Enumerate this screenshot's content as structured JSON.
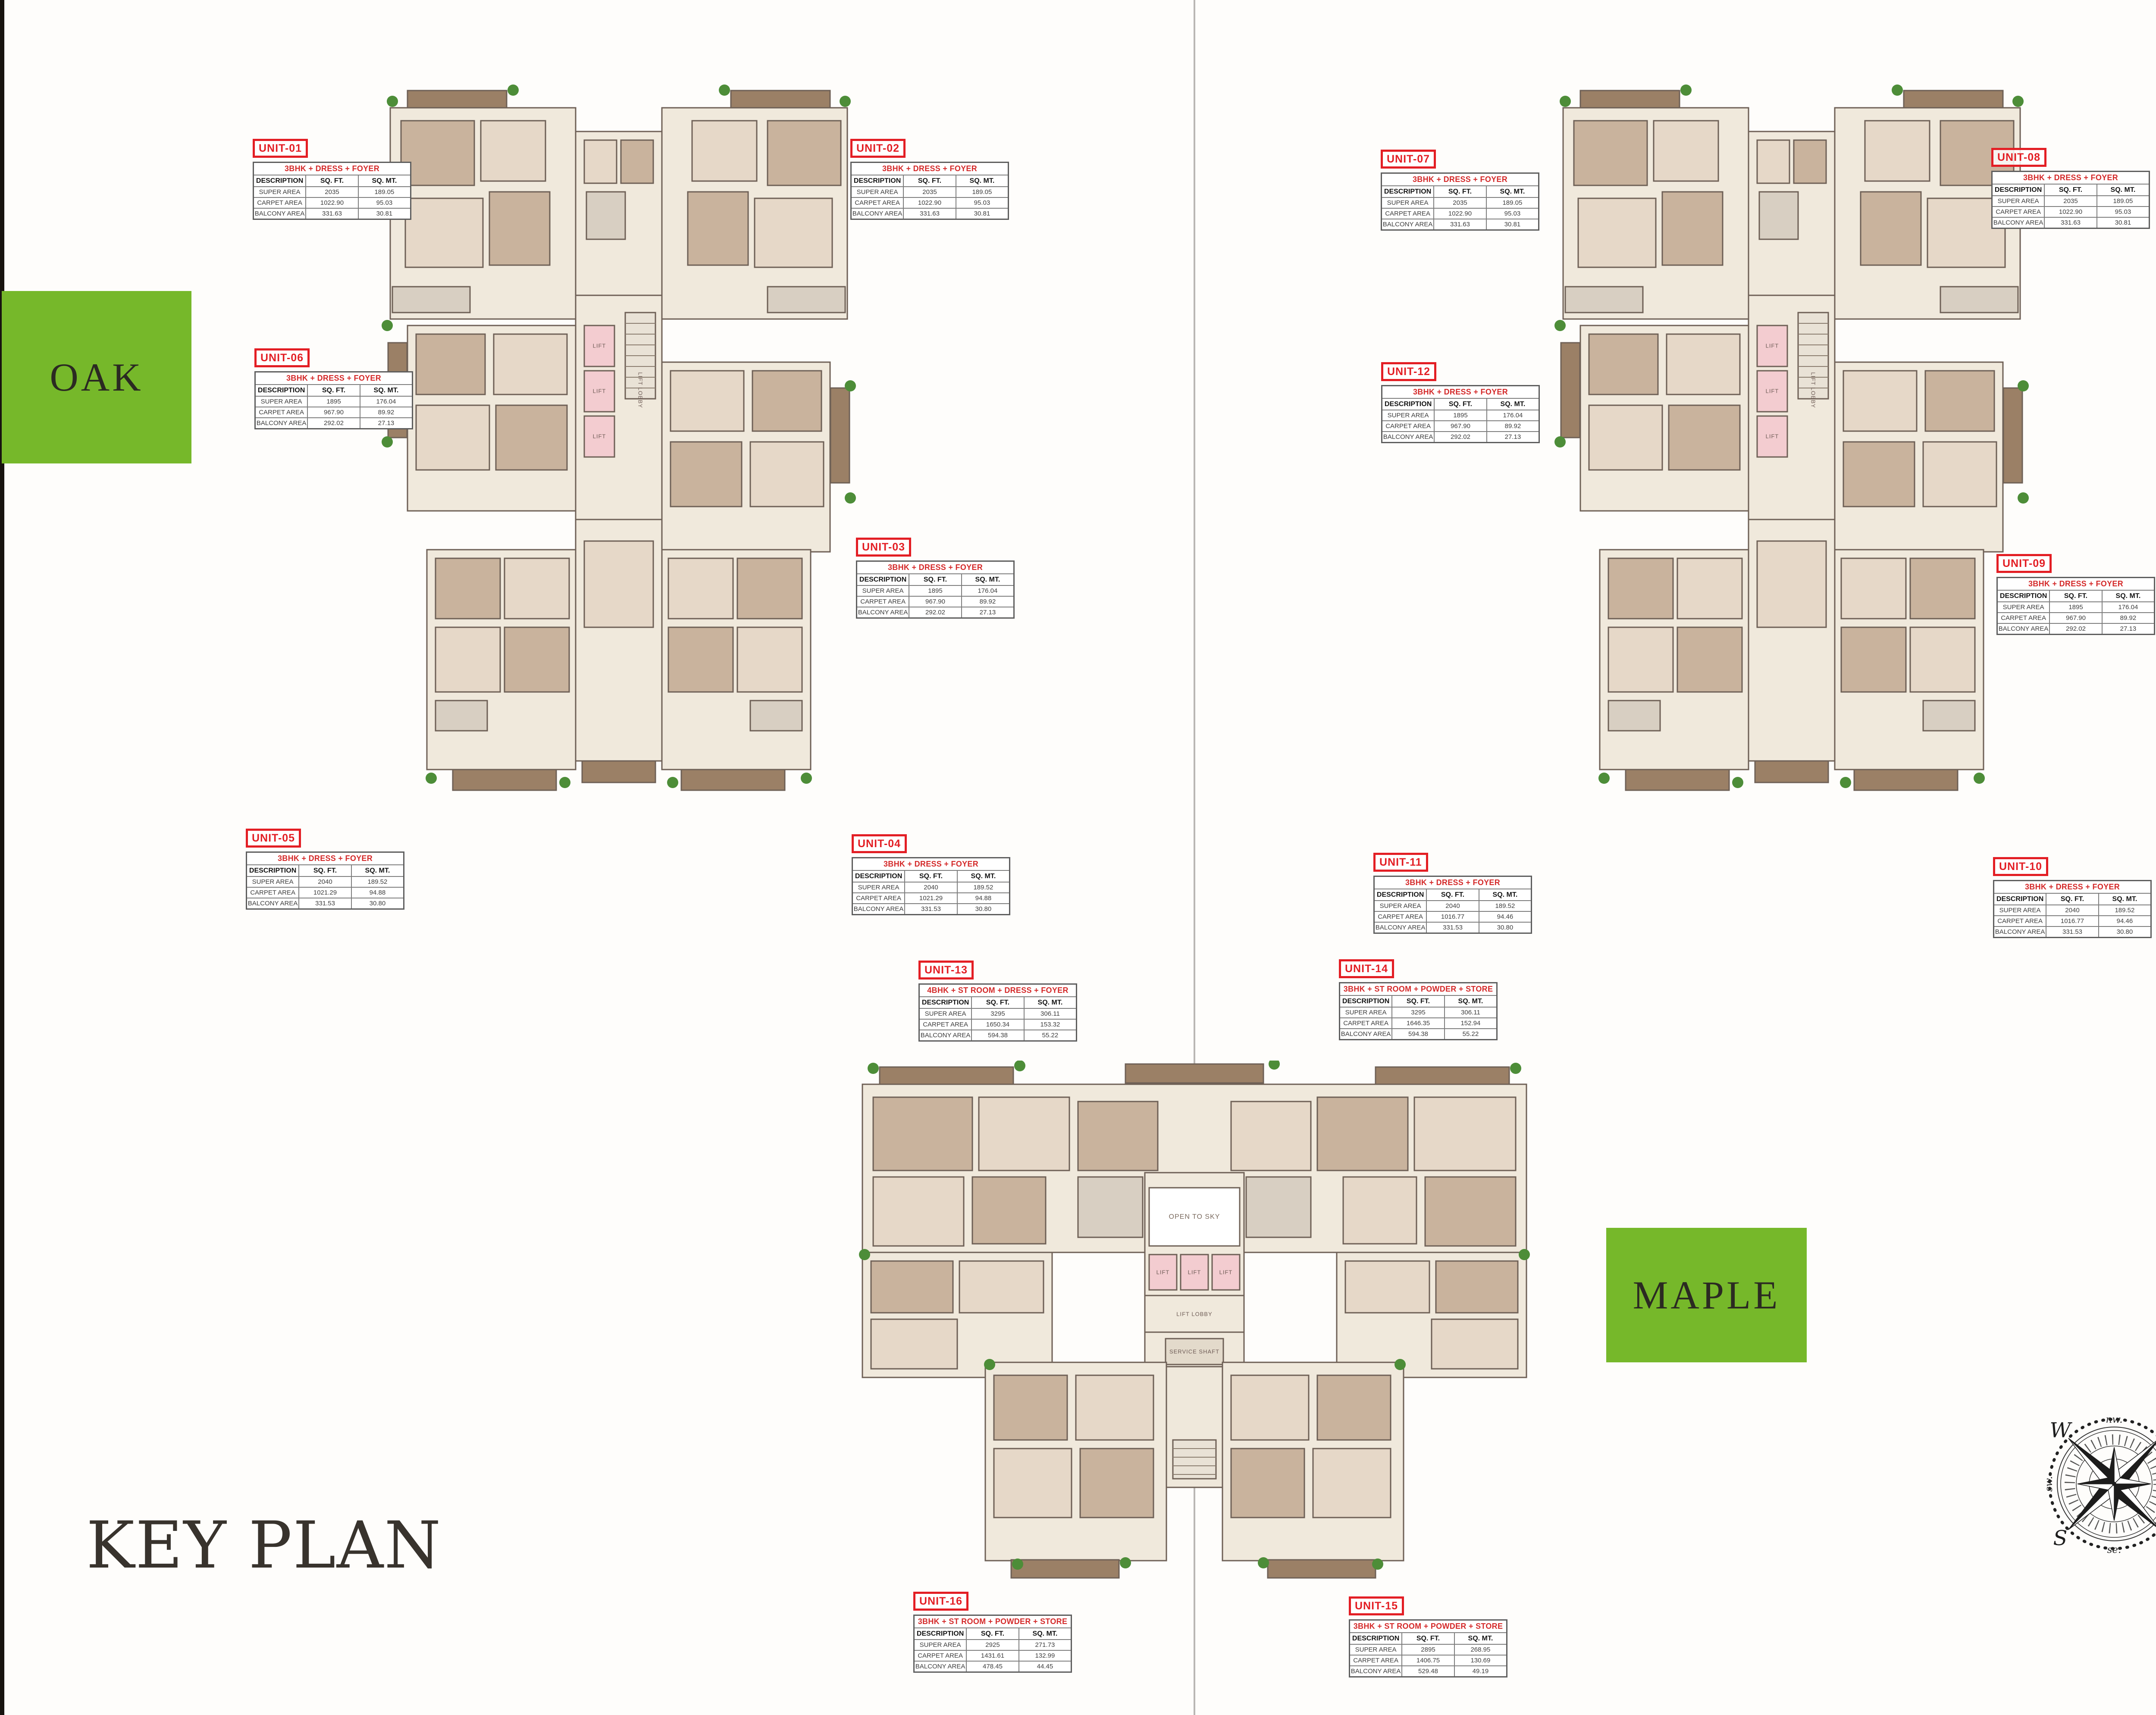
{
  "page": {
    "key_plan_label": "KEY PLAN"
  },
  "buildings": {
    "oak": "OAK",
    "olive": "OLIVE",
    "maple": "MAPLE"
  },
  "table_headers": {
    "description": "DESCRIPTION",
    "sqft": "SQ. FT.",
    "sqmt": "SQ. MT."
  },
  "row_labels": {
    "super": "SUPER AREA",
    "carpet": "CARPET AREA",
    "balcony": "BALCONY AREA"
  },
  "units": [
    {
      "id": "UNIT-01",
      "type": "3BHK + DRESS + FOYER",
      "super": [
        "2035",
        "189.05"
      ],
      "carpet": [
        "1022.90",
        "95.03"
      ],
      "balcony": [
        "331.63",
        "30.81"
      ]
    },
    {
      "id": "UNIT-02",
      "type": "3BHK + DRESS + FOYER",
      "super": [
        "2035",
        "189.05"
      ],
      "carpet": [
        "1022.90",
        "95.03"
      ],
      "balcony": [
        "331.63",
        "30.81"
      ]
    },
    {
      "id": "UNIT-03",
      "type": "3BHK + DRESS + FOYER",
      "super": [
        "1895",
        "176.04"
      ],
      "carpet": [
        "967.90",
        "89.92"
      ],
      "balcony": [
        "292.02",
        "27.13"
      ]
    },
    {
      "id": "UNIT-04",
      "type": "3BHK + DRESS + FOYER",
      "super": [
        "2040",
        "189.52"
      ],
      "carpet": [
        "1021.29",
        "94.88"
      ],
      "balcony": [
        "331.53",
        "30.80"
      ]
    },
    {
      "id": "UNIT-05",
      "type": "3BHK + DRESS + FOYER",
      "super": [
        "2040",
        "189.52"
      ],
      "carpet": [
        "1021.29",
        "94.88"
      ],
      "balcony": [
        "331.53",
        "30.80"
      ]
    },
    {
      "id": "UNIT-06",
      "type": "3BHK + DRESS + FOYER",
      "super": [
        "1895",
        "176.04"
      ],
      "carpet": [
        "967.90",
        "89.92"
      ],
      "balcony": [
        "292.02",
        "27.13"
      ]
    },
    {
      "id": "UNIT-07",
      "type": "3BHK + DRESS + FOYER",
      "super": [
        "2035",
        "189.05"
      ],
      "carpet": [
        "1022.90",
        "95.03"
      ],
      "balcony": [
        "331.63",
        "30.81"
      ]
    },
    {
      "id": "UNIT-08",
      "type": "3BHK + DRESS + FOYER",
      "super": [
        "2035",
        "189.05"
      ],
      "carpet": [
        "1022.90",
        "95.03"
      ],
      "balcony": [
        "331.63",
        "30.81"
      ]
    },
    {
      "id": "UNIT-09",
      "type": "3BHK + DRESS + FOYER",
      "super": [
        "1895",
        "176.04"
      ],
      "carpet": [
        "967.90",
        "89.92"
      ],
      "balcony": [
        "292.02",
        "27.13"
      ]
    },
    {
      "id": "UNIT-10",
      "type": "3BHK + DRESS + FOYER",
      "super": [
        "2040",
        "189.52"
      ],
      "carpet": [
        "1016.77",
        "94.46"
      ],
      "balcony": [
        "331.53",
        "30.80"
      ]
    },
    {
      "id": "UNIT-11",
      "type": "3BHK + DRESS + FOYER",
      "super": [
        "2040",
        "189.52"
      ],
      "carpet": [
        "1016.77",
        "94.46"
      ],
      "balcony": [
        "331.53",
        "30.80"
      ]
    },
    {
      "id": "UNIT-12",
      "type": "3BHK + DRESS + FOYER",
      "super": [
        "1895",
        "176.04"
      ],
      "carpet": [
        "967.90",
        "89.92"
      ],
      "balcony": [
        "292.02",
        "27.13"
      ]
    },
    {
      "id": "UNIT-13",
      "type": "4BHK + ST ROOM + DRESS + FOYER",
      "super": [
        "3295",
        "306.11"
      ],
      "carpet": [
        "1650.34",
        "153.32"
      ],
      "balcony": [
        "594.38",
        "55.22"
      ]
    },
    {
      "id": "UNIT-14",
      "type": "3BHK + ST ROOM + POWDER + STORE",
      "super": [
        "3295",
        "306.11"
      ],
      "carpet": [
        "1646.35",
        "152.94"
      ],
      "balcony": [
        "594.38",
        "55.22"
      ]
    },
    {
      "id": "UNIT-15",
      "type": "3BHK + ST ROOM + POWDER + STORE",
      "super": [
        "2895",
        "268.95"
      ],
      "carpet": [
        "1406.75",
        "130.69"
      ],
      "balcony": [
        "529.48",
        "49.19"
      ]
    },
    {
      "id": "UNIT-16",
      "type": "3BHK + ST ROOM + POWDER + STORE",
      "super": [
        "2925",
        "271.73"
      ],
      "carpet": [
        "1431.61",
        "132.99"
      ],
      "balcony": [
        "478.45",
        "44.45"
      ]
    }
  ],
  "plan_labels": {
    "lift": "LIFT",
    "lift_lobby": "LIFT LOBBY",
    "open_to_sky": "OPEN TO SKY",
    "service_shaft": "SERVICE SHAFT"
  },
  "compass": {
    "n": "N",
    "e": "E",
    "s": "S",
    "w": "W",
    "ne": "ne.",
    "nw": "nw.",
    "se": "se.",
    "sw": "sw."
  },
  "colors": {
    "brand_green": "#76b82a",
    "unit_red": "#e31e24",
    "title_dark": "#38332d"
  }
}
